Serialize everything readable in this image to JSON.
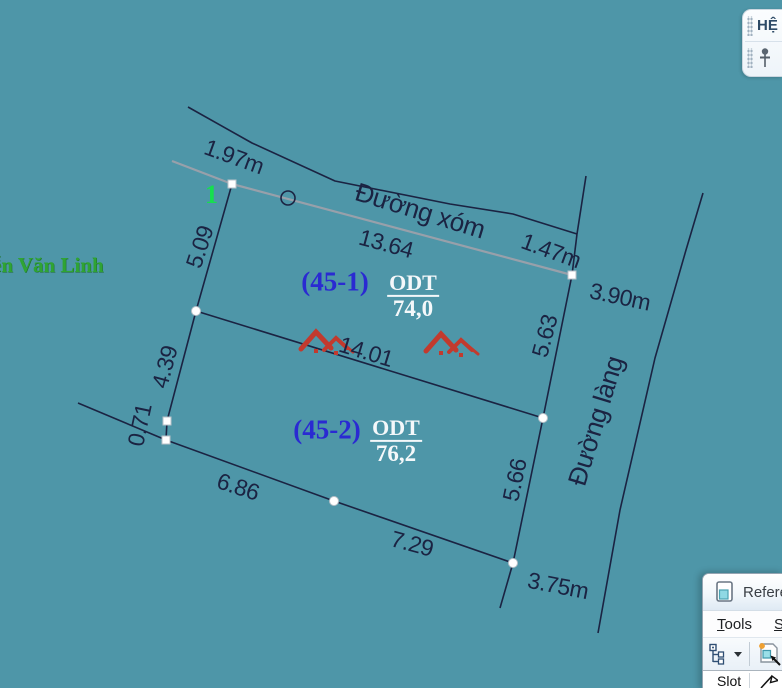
{
  "scene": {
    "bg": "#4e96a8",
    "line": "#1b2342",
    "sel": "#98a0aa",
    "vertex_fill": "#ffffff",
    "vertex_stroke": "#b9c2c9",
    "logo_red": "#c23a2e"
  },
  "drawing": {
    "lines": [
      {
        "name": "road-top-edge",
        "color": "line",
        "w": 1.6,
        "pts": [
          [
            188,
            107
          ],
          [
            252,
            143
          ],
          [
            335,
            181
          ],
          [
            450,
            204
          ],
          [
            513,
            214
          ],
          [
            577,
            234
          ]
        ]
      },
      {
        "name": "road-top-stub",
        "color": "line",
        "w": 1.6,
        "pts": [
          [
            586,
            176
          ],
          [
            577,
            234
          ]
        ]
      },
      {
        "name": "frontage-segment",
        "color": "line",
        "w": 1.6,
        "pts": [
          [
            577,
            234
          ],
          [
            572,
            275
          ]
        ]
      },
      {
        "name": "north-boundary",
        "color": "sel",
        "w": 2.2,
        "pts": [
          [
            172,
            161
          ],
          [
            232,
            184
          ],
          [
            572,
            275
          ]
        ]
      },
      {
        "name": "west-boundary",
        "color": "line",
        "w": 1.6,
        "pts": [
          [
            232,
            184
          ],
          [
            196,
            311
          ],
          [
            167,
            421
          ],
          [
            166,
            440
          ]
        ]
      },
      {
        "name": "neighbor-line",
        "color": "line",
        "w": 1.6,
        "pts": [
          [
            78,
            403
          ],
          [
            166,
            440
          ]
        ]
      },
      {
        "name": "south-boundary",
        "color": "line",
        "w": 1.6,
        "pts": [
          [
            166,
            440
          ],
          [
            334,
            501
          ],
          [
            513,
            563
          ],
          [
            500,
            608
          ]
        ]
      },
      {
        "name": "division-line",
        "color": "line",
        "w": 1.6,
        "pts": [
          [
            196,
            311
          ],
          [
            543,
            418
          ]
        ]
      },
      {
        "name": "east-boundary",
        "color": "line",
        "w": 1.6,
        "pts": [
          [
            572,
            275
          ],
          [
            543,
            418
          ],
          [
            513,
            563
          ]
        ]
      },
      {
        "name": "road-east-edge",
        "color": "line",
        "w": 1.6,
        "pts": [
          [
            703,
            193
          ],
          [
            686,
            250
          ],
          [
            655,
            358
          ],
          [
            620,
            510
          ],
          [
            598,
            633
          ]
        ]
      }
    ],
    "circle_marker": {
      "cx": 288,
      "cy": 198,
      "r": 7
    },
    "vertices": [
      {
        "x": 232,
        "y": 184,
        "shape": "square"
      },
      {
        "x": 572,
        "y": 275,
        "shape": "square"
      },
      {
        "x": 196,
        "y": 311,
        "shape": "round"
      },
      {
        "x": 167,
        "y": 421,
        "shape": "square"
      },
      {
        "x": 166,
        "y": 440,
        "shape": "square"
      },
      {
        "x": 543,
        "y": 418,
        "shape": "round"
      },
      {
        "x": 334,
        "y": 501,
        "shape": "round"
      },
      {
        "x": 513,
        "y": 563,
        "shape": "round"
      }
    ],
    "dim_labels": [
      {
        "text": "1.97m",
        "x": 234,
        "y": 157,
        "rot": 20
      },
      {
        "text": "13.64",
        "x": 386,
        "y": 244,
        "rot": 15
      },
      {
        "text": "1.47m",
        "x": 551,
        "y": 251,
        "rot": 20
      },
      {
        "text": "3.90m",
        "x": 620,
        "y": 297,
        "rot": 12
      },
      {
        "text": "5.09",
        "x": 200,
        "y": 247,
        "rot": -72
      },
      {
        "text": "5.63",
        "x": 545,
        "y": 336,
        "rot": -75
      },
      {
        "text": "4.39",
        "x": 165,
        "y": 367,
        "rot": -75
      },
      {
        "text": "0.71",
        "x": 140,
        "y": 425,
        "rot": -78
      },
      {
        "text": "14.01",
        "x": 366,
        "y": 352,
        "rot": 17
      },
      {
        "text": "6.86",
        "x": 238,
        "y": 487,
        "rot": 18
      },
      {
        "text": "7.29",
        "x": 412,
        "y": 544,
        "rot": 15
      },
      {
        "text": "5.66",
        "x": 515,
        "y": 480,
        "rot": -78
      },
      {
        "text": "3.75m",
        "x": 558,
        "y": 586,
        "rot": 11
      }
    ],
    "road_labels": [
      {
        "text": "Đường xóm",
        "x": 420,
        "y": 211,
        "rot": 17
      },
      {
        "text": "Đường làng",
        "x": 596,
        "y": 421,
        "rot": -73
      }
    ],
    "parcels": [
      {
        "id": "(45-1)",
        "id_x": 335,
        "id_y": 282,
        "code": "ODT",
        "area": "74,0",
        "frac_x": 413,
        "frac_y": 296
      },
      {
        "id": "(45-2)",
        "id_x": 327,
        "id_y": 430,
        "code": "ODT",
        "area": "76,2",
        "frac_x": 396,
        "frac_y": 441
      }
    ],
    "logos": [
      {
        "x": 300,
        "y": 326
      },
      {
        "x": 425,
        "y": 328
      }
    ],
    "street_text": {
      "text": "ễn Văn Linh",
      "x": -8,
      "y": 253
    },
    "vertex_number": {
      "text": "1",
      "x": 205,
      "y": 182
    }
  },
  "system_panel": {
    "title": "HỆ T"
  },
  "reference_dialog": {
    "title": "Referen",
    "menu_items": [
      {
        "mnemonic": "T",
        "rest": "ools"
      },
      {
        "mnemonic": "S",
        "rest": "e"
      }
    ],
    "column_header": "Slot"
  }
}
